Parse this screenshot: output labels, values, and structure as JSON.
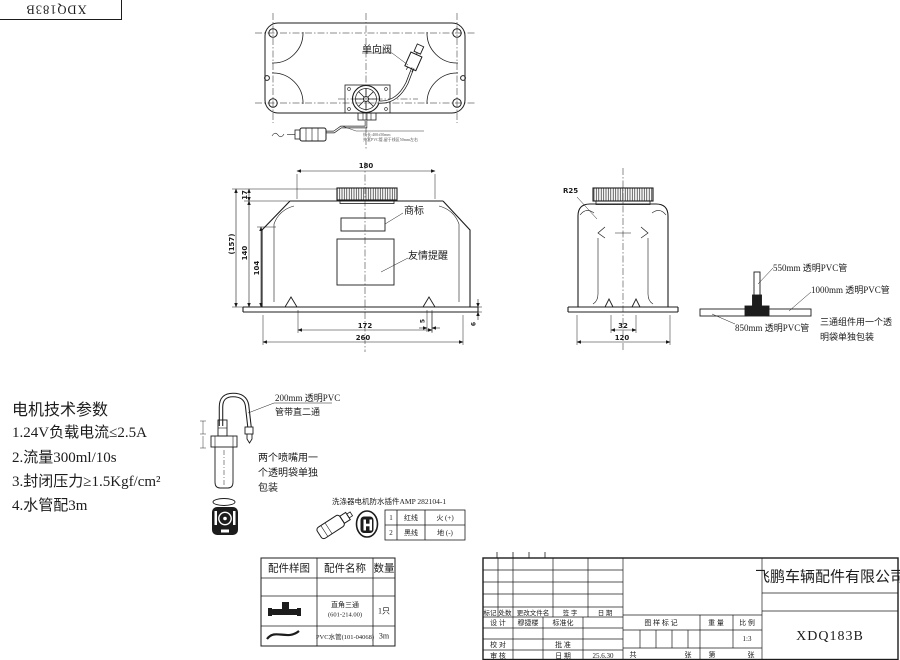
{
  "corner_code": "XDQ183B",
  "top_view": {
    "check_valve_label": "单向阀",
    "wire_note_line1": "线长:400±50mm",
    "wire_note_line2": "外套PVC管,留于线区50mm左右"
  },
  "front_view": {
    "dim_width_top": "180",
    "dim_cap_height": "17",
    "dim_total_height": "(157)",
    "dim_body_height": "140",
    "dim_lower_height": "104",
    "dim_feet_span": "172",
    "dim_width_bottom": "260",
    "dim_foot_offset": "5",
    "dim_brim_height": "6",
    "trademark_label": "商标",
    "reminder_label": "友情提醒"
  },
  "side_view": {
    "radius_label": "R25",
    "dim_inner": "32",
    "dim_width": "120"
  },
  "tube_assembly": {
    "tube_550": "550mm 透明PVC管",
    "tube_1000": "1000mm 透明PVC管",
    "tube_850": "850mm 透明PVC管",
    "note_line1": "三通组件用一个透",
    "note_line2": "明袋单独包装"
  },
  "motor_params": {
    "title": "电机技术参数",
    "items": [
      "1.24V负载电流≤2.5A",
      "2.流量300ml/10s",
      "3.封闭压力≥1.5Kgf/cm²",
      "4.水管配3m"
    ]
  },
  "nozzle": {
    "tube_label_line1": "200mm 透明PVC",
    "tube_label_line2": "管带直二通",
    "note_line1": "两个喷嘴用一",
    "note_line2": "个透明袋单独",
    "note_line3": "包装"
  },
  "connector": {
    "title": "洗涤器电机防水插件AMP 282104-1",
    "pins": [
      {
        "no": "1",
        "wire": "红线",
        "role": "火 (+)"
      },
      {
        "no": "2",
        "wire": "黑线",
        "role": "地 (-)"
      }
    ]
  },
  "parts_table": {
    "headers": [
      "配件样图",
      "配件名称",
      "数量"
    ],
    "rows": [
      {
        "name_line1": "直角三通",
        "name_line2": "(601-214.00)",
        "qty": "1只"
      },
      {
        "name_line1": "PVC水管(101-04068)",
        "name_line2": "",
        "qty": "3m"
      }
    ]
  },
  "title_block": {
    "company": "飞鹏车辆配件有限公司",
    "drawing_no": "XDQ183B",
    "rev_headers": [
      "标记",
      "处数",
      "更改文件名",
      "签 字",
      "日 期"
    ],
    "design_label": "设 计",
    "designer": "穆捷楼",
    "standard_label": "标准化",
    "check_label": "校 对",
    "approve_label": "批 准",
    "review_label": "审 核",
    "date_label": "日 期",
    "date_value": "25.6.30",
    "stamp_label": "图 样 标 记",
    "weight_label": "重 量",
    "scale_label": "比 例",
    "scale_value": "1:3",
    "sheet_total_label": "共",
    "sheet_unit1": "张",
    "sheet_no_label": "第",
    "sheet_unit2": "张"
  }
}
